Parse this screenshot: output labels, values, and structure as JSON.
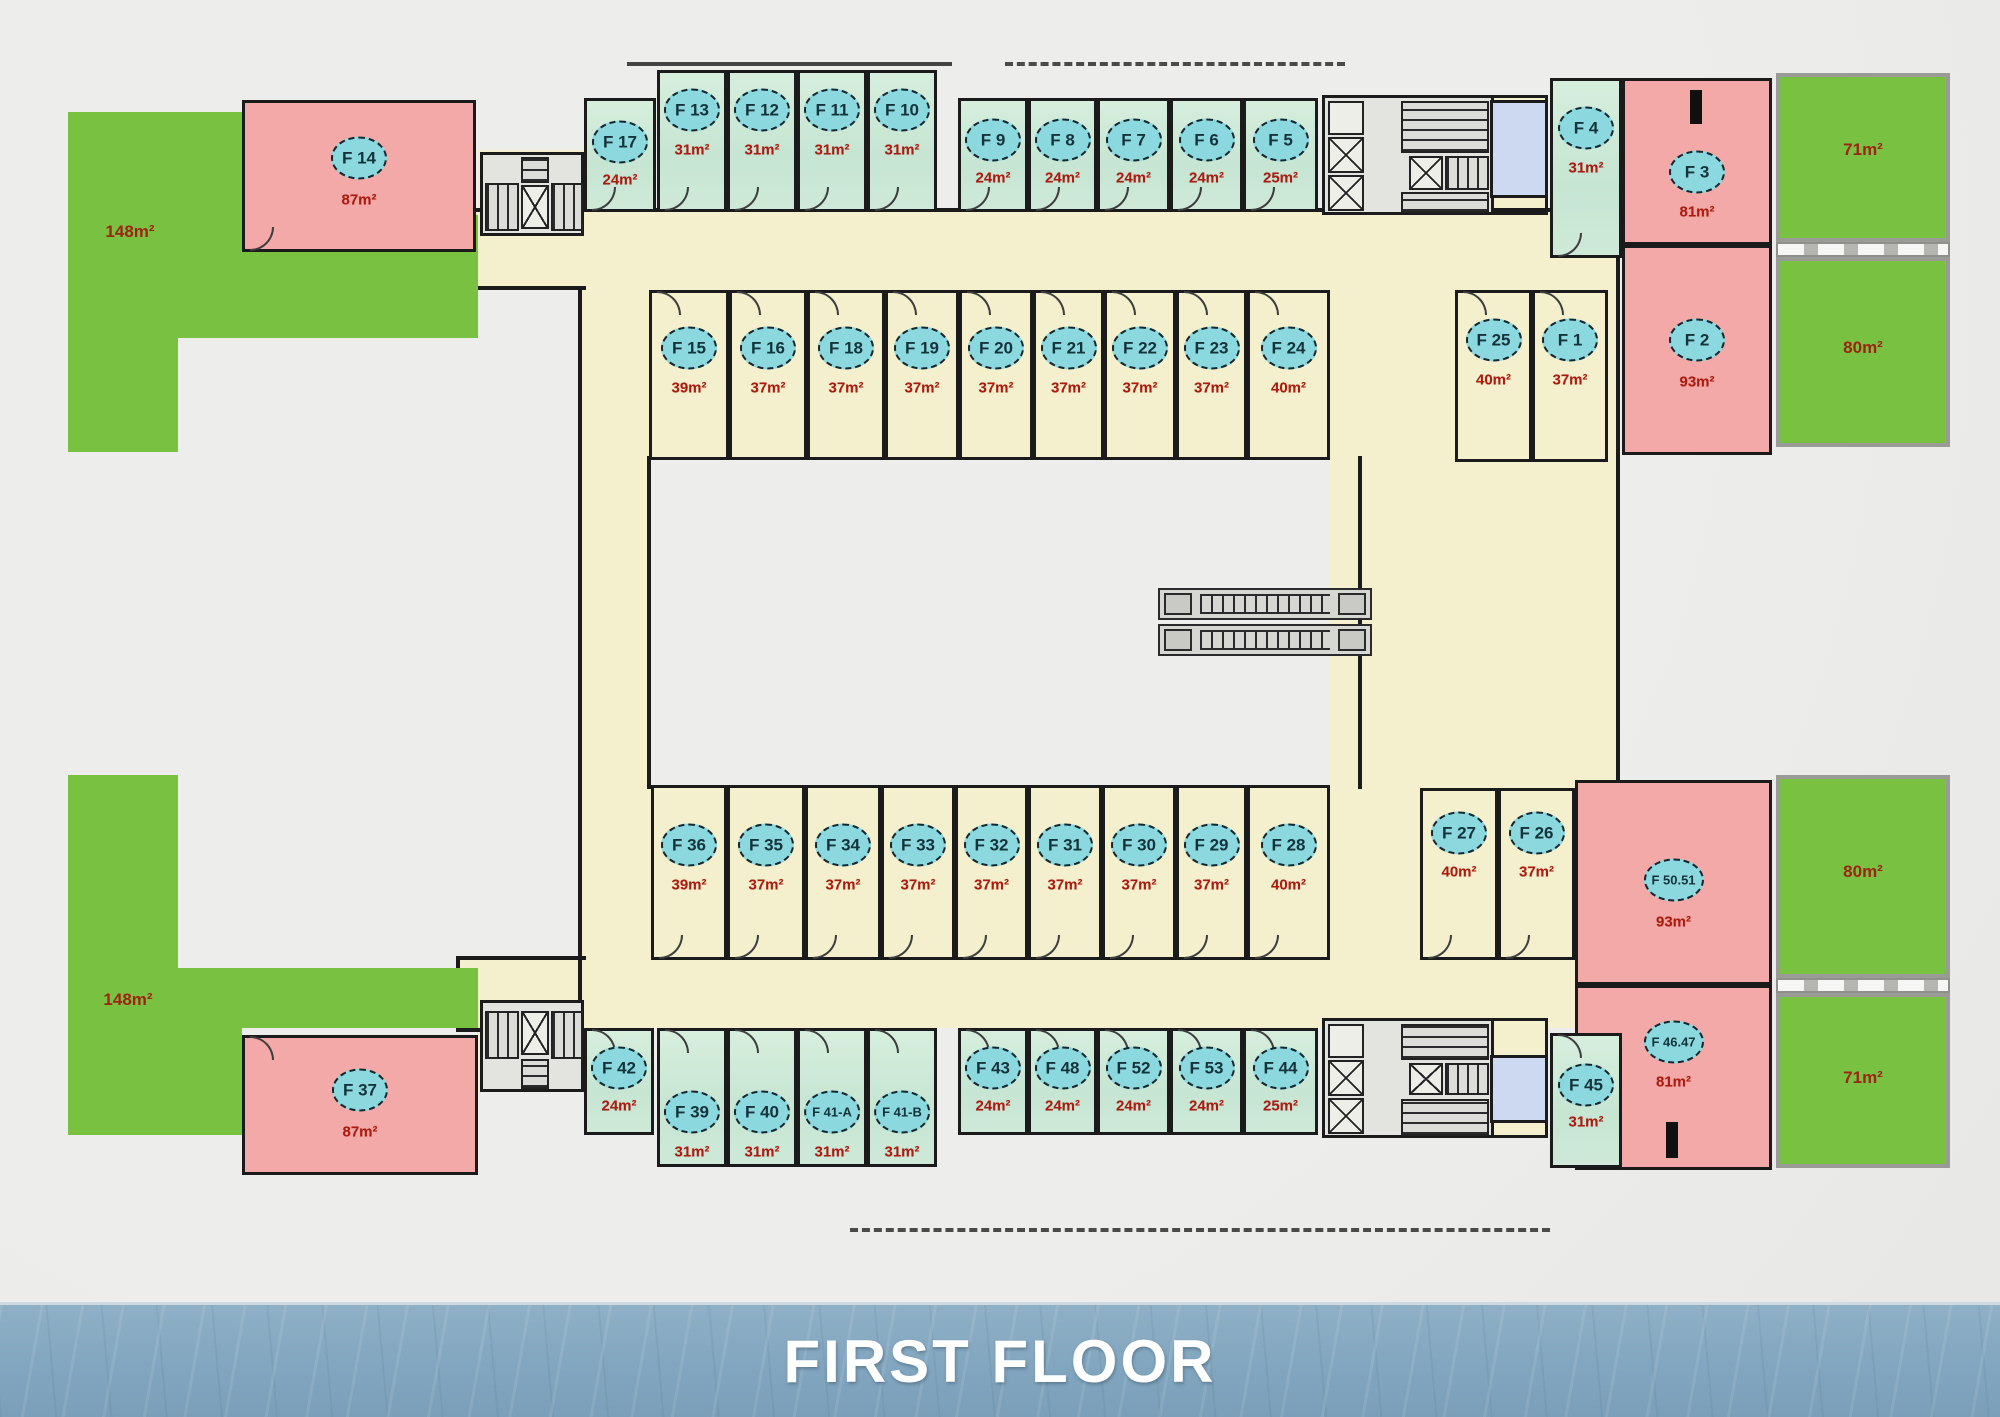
{
  "banner": {
    "title": "FIRST FLOOR"
  },
  "colors": {
    "terrace_green": "#79c141",
    "unit_pink": "#f3a9a7",
    "unit_teal": "#cde9d8",
    "unit_cream": "#f4f0cd",
    "wc_blue": "#cdd9f0",
    "badge_cyan": "#8bd8de",
    "area_red": "#ab1b10",
    "wall_black": "#1b1b1b",
    "banner_blue": "#82a6bf"
  },
  "rooms": [
    {
      "id": "F14",
      "label": "F 14",
      "area": "87m²",
      "fill": "pink",
      "x": 242,
      "y": 100,
      "w": 234,
      "h": 152,
      "by": 158,
      "ay": 200,
      "door": "bottom"
    },
    {
      "id": "F37",
      "label": "F 37",
      "area": "87m²",
      "fill": "pink",
      "x": 242,
      "y": 1035,
      "w": 236,
      "h": 140,
      "by": 1090,
      "ay": 1132,
      "door": "top"
    },
    {
      "id": "F17",
      "label": "F 17",
      "area": "24m²",
      "fill": "teal",
      "x": 584,
      "y": 98,
      "w": 72,
      "h": 114,
      "by": 142,
      "ay": 180,
      "door": "bottom"
    },
    {
      "id": "F13",
      "label": "F 13",
      "area": "31m²",
      "fill": "teal",
      "x": 657,
      "y": 70,
      "w": 70,
      "h": 142,
      "by": 110,
      "ay": 150,
      "door": "bottom"
    },
    {
      "id": "F12",
      "label": "F 12",
      "area": "31m²",
      "fill": "teal",
      "x": 727,
      "y": 70,
      "w": 70,
      "h": 142,
      "by": 110,
      "ay": 150,
      "door": "bottom"
    },
    {
      "id": "F11",
      "label": "F 11",
      "area": "31m²",
      "fill": "teal",
      "x": 797,
      "y": 70,
      "w": 70,
      "h": 142,
      "by": 110,
      "ay": 150,
      "door": "bottom"
    },
    {
      "id": "F10",
      "label": "F 10",
      "area": "31m²",
      "fill": "teal",
      "x": 867,
      "y": 70,
      "w": 70,
      "h": 142,
      "by": 110,
      "ay": 150,
      "door": "bottom"
    },
    {
      "id": "F9",
      "label": "F 9",
      "area": "24m²",
      "fill": "teal",
      "x": 958,
      "y": 98,
      "w": 70,
      "h": 114,
      "by": 140,
      "ay": 178,
      "door": "bottom"
    },
    {
      "id": "F8",
      "label": "F 8",
      "area": "24m²",
      "fill": "teal",
      "x": 1028,
      "y": 98,
      "w": 69,
      "h": 114,
      "by": 140,
      "ay": 178,
      "door": "bottom"
    },
    {
      "id": "F7",
      "label": "F 7",
      "area": "24m²",
      "fill": "teal",
      "x": 1097,
      "y": 98,
      "w": 73,
      "h": 114,
      "by": 140,
      "ay": 178,
      "door": "bottom"
    },
    {
      "id": "F6",
      "label": "F 6",
      "area": "24m²",
      "fill": "teal",
      "x": 1170,
      "y": 98,
      "w": 73,
      "h": 114,
      "by": 140,
      "ay": 178,
      "door": "bottom"
    },
    {
      "id": "F5",
      "label": "F 5",
      "area": "25m²",
      "fill": "teal",
      "x": 1243,
      "y": 98,
      "w": 75,
      "h": 114,
      "by": 140,
      "ay": 178,
      "door": "bottom"
    },
    {
      "id": "F4",
      "label": "F 4",
      "area": "31m²",
      "fill": "teal",
      "x": 1550,
      "y": 78,
      "w": 72,
      "h": 180,
      "by": 128,
      "ay": 168,
      "door": "bottom"
    },
    {
      "id": "F3",
      "label": "F 3",
      "area": "81m²",
      "fill": "pink",
      "x": 1622,
      "y": 78,
      "w": 150,
      "h": 167,
      "by": 172,
      "ay": 212,
      "door": "none"
    },
    {
      "id": "F2",
      "label": "F 2",
      "area": "93m²",
      "fill": "pink",
      "x": 1622,
      "y": 245,
      "w": 150,
      "h": 210,
      "by": 340,
      "ay": 382,
      "door": "none"
    },
    {
      "id": "F25",
      "label": "F 25",
      "area": "40m²",
      "fill": "cream",
      "x": 1455,
      "y": 290,
      "w": 77,
      "h": 172,
      "by": 340,
      "ay": 380,
      "door": "top"
    },
    {
      "id": "F1",
      "label": "F 1",
      "area": "37m²",
      "fill": "cream",
      "x": 1532,
      "y": 290,
      "w": 76,
      "h": 172,
      "by": 340,
      "ay": 380,
      "door": "top"
    },
    {
      "id": "F15",
      "label": "F 15",
      "area": "39m²",
      "fill": "cream",
      "x": 649,
      "y": 290,
      "w": 80,
      "h": 170,
      "by": 348,
      "ay": 388,
      "door": "top"
    },
    {
      "id": "F16",
      "label": "F 16",
      "area": "37m²",
      "fill": "cream",
      "x": 729,
      "y": 290,
      "w": 78,
      "h": 170,
      "by": 348,
      "ay": 388,
      "door": "top"
    },
    {
      "id": "F18",
      "label": "F 18",
      "area": "37m²",
      "fill": "cream",
      "x": 807,
      "y": 290,
      "w": 78,
      "h": 170,
      "by": 348,
      "ay": 388,
      "door": "top"
    },
    {
      "id": "F19",
      "label": "F 19",
      "area": "37m²",
      "fill": "cream",
      "x": 885,
      "y": 290,
      "w": 74,
      "h": 170,
      "by": 348,
      "ay": 388,
      "door": "top"
    },
    {
      "id": "F20",
      "label": "F 20",
      "area": "37m²",
      "fill": "cream",
      "x": 959,
      "y": 290,
      "w": 74,
      "h": 170,
      "by": 348,
      "ay": 388,
      "door": "top"
    },
    {
      "id": "F21",
      "label": "F 21",
      "area": "37m²",
      "fill": "cream",
      "x": 1033,
      "y": 290,
      "w": 71,
      "h": 170,
      "by": 348,
      "ay": 388,
      "door": "top"
    },
    {
      "id": "F22",
      "label": "F 22",
      "area": "37m²",
      "fill": "cream",
      "x": 1104,
      "y": 290,
      "w": 72,
      "h": 170,
      "by": 348,
      "ay": 388,
      "door": "top"
    },
    {
      "id": "F23",
      "label": "F 23",
      "area": "37m²",
      "fill": "cream",
      "x": 1176,
      "y": 290,
      "w": 71,
      "h": 170,
      "by": 348,
      "ay": 388,
      "door": "top"
    },
    {
      "id": "F24",
      "label": "F 24",
      "area": "40m²",
      "fill": "cream",
      "x": 1247,
      "y": 290,
      "w": 83,
      "h": 170,
      "by": 348,
      "ay": 388,
      "door": "top"
    },
    {
      "id": "F36",
      "label": "F 36",
      "area": "39m²",
      "fill": "cream",
      "x": 651,
      "y": 785,
      "w": 76,
      "h": 175,
      "by": 845,
      "ay": 885,
      "door": "bottom"
    },
    {
      "id": "F35",
      "label": "F 35",
      "area": "37m²",
      "fill": "cream",
      "x": 727,
      "y": 785,
      "w": 78,
      "h": 175,
      "by": 845,
      "ay": 885,
      "door": "bottom"
    },
    {
      "id": "F34",
      "label": "F 34",
      "area": "37m²",
      "fill": "cream",
      "x": 805,
      "y": 785,
      "w": 76,
      "h": 175,
      "by": 845,
      "ay": 885,
      "door": "bottom"
    },
    {
      "id": "F33",
      "label": "F 33",
      "area": "37m²",
      "fill": "cream",
      "x": 881,
      "y": 785,
      "w": 74,
      "h": 175,
      "by": 845,
      "ay": 885,
      "door": "bottom"
    },
    {
      "id": "F32",
      "label": "F 32",
      "area": "37m²",
      "fill": "cream",
      "x": 955,
      "y": 785,
      "w": 73,
      "h": 175,
      "by": 845,
      "ay": 885,
      "door": "bottom"
    },
    {
      "id": "F31",
      "label": "F 31",
      "area": "37m²",
      "fill": "cream",
      "x": 1028,
      "y": 785,
      "w": 74,
      "h": 175,
      "by": 845,
      "ay": 885,
      "door": "bottom"
    },
    {
      "id": "F30",
      "label": "F 30",
      "area": "37m²",
      "fill": "cream",
      "x": 1102,
      "y": 785,
      "w": 74,
      "h": 175,
      "by": 845,
      "ay": 885,
      "door": "bottom"
    },
    {
      "id": "F29",
      "label": "F 29",
      "area": "37m²",
      "fill": "cream",
      "x": 1176,
      "y": 785,
      "w": 71,
      "h": 175,
      "by": 845,
      "ay": 885,
      "door": "bottom"
    },
    {
      "id": "F28",
      "label": "F 28",
      "area": "40m²",
      "fill": "cream",
      "x": 1247,
      "y": 785,
      "w": 83,
      "h": 175,
      "by": 845,
      "ay": 885,
      "door": "bottom"
    },
    {
      "id": "F27",
      "label": "F 27",
      "area": "40m²",
      "fill": "cream",
      "x": 1420,
      "y": 788,
      "w": 78,
      "h": 172,
      "by": 833,
      "ay": 872,
      "door": "bottom"
    },
    {
      "id": "F26",
      "label": "F 26",
      "area": "37m²",
      "fill": "cream",
      "x": 1498,
      "y": 788,
      "w": 77,
      "h": 172,
      "by": 833,
      "ay": 872,
      "door": "bottom"
    },
    {
      "id": "F50.51",
      "label": "F 50.51",
      "area": "93m²",
      "fill": "pink",
      "x": 1575,
      "y": 780,
      "w": 197,
      "h": 205,
      "by": 880,
      "ay": 922,
      "door": "none"
    },
    {
      "id": "F46.47",
      "label": "F 46.47",
      "area": "81m²",
      "fill": "pink",
      "x": 1575,
      "y": 985,
      "w": 197,
      "h": 185,
      "by": 1042,
      "ay": 1082,
      "door": "none"
    },
    {
      "id": "F45",
      "label": "F 45",
      "area": "31m²",
      "fill": "teal",
      "x": 1550,
      "y": 1033,
      "w": 72,
      "h": 135,
      "by": 1085,
      "ay": 1122,
      "door": "top"
    },
    {
      "id": "F42",
      "label": "F 42",
      "area": "24m²",
      "fill": "teal",
      "x": 584,
      "y": 1028,
      "w": 70,
      "h": 107,
      "by": 1068,
      "ay": 1106,
      "door": "top"
    },
    {
      "id": "F39",
      "label": "F 39",
      "area": "31m²",
      "fill": "teal",
      "x": 657,
      "y": 1028,
      "w": 70,
      "h": 139,
      "by": 1112,
      "ay": 1152,
      "door": "top"
    },
    {
      "id": "F40",
      "label": "F 40",
      "area": "31m²",
      "fill": "teal",
      "x": 727,
      "y": 1028,
      "w": 70,
      "h": 139,
      "by": 1112,
      "ay": 1152,
      "door": "top"
    },
    {
      "id": "F41-A",
      "label": "F 41-A",
      "area": "31m²",
      "fill": "teal",
      "x": 797,
      "y": 1028,
      "w": 70,
      "h": 139,
      "by": 1112,
      "ay": 1152,
      "door": "top"
    },
    {
      "id": "F41-B",
      "label": "F 41-B",
      "area": "31m²",
      "fill": "teal",
      "x": 867,
      "y": 1028,
      "w": 70,
      "h": 139,
      "by": 1112,
      "ay": 1152,
      "door": "top"
    },
    {
      "id": "F43",
      "label": "F 43",
      "area": "24m²",
      "fill": "teal",
      "x": 958,
      "y": 1028,
      "w": 70,
      "h": 107,
      "by": 1068,
      "ay": 1106,
      "door": "top"
    },
    {
      "id": "F48",
      "label": "F 48",
      "area": "24m²",
      "fill": "teal",
      "x": 1028,
      "y": 1028,
      "w": 69,
      "h": 107,
      "by": 1068,
      "ay": 1106,
      "door": "top"
    },
    {
      "id": "F52",
      "label": "F 52",
      "area": "24m²",
      "fill": "teal",
      "x": 1097,
      "y": 1028,
      "w": 73,
      "h": 107,
      "by": 1068,
      "ay": 1106,
      "door": "top"
    },
    {
      "id": "F53",
      "label": "F 53",
      "area": "24m²",
      "fill": "teal",
      "x": 1170,
      "y": 1028,
      "w": 73,
      "h": 107,
      "by": 1068,
      "ay": 1106,
      "door": "top"
    },
    {
      "id": "F44",
      "label": "F 44",
      "area": "25m²",
      "fill": "teal",
      "x": 1243,
      "y": 1028,
      "w": 75,
      "h": 107,
      "by": 1068,
      "ay": 1106,
      "door": "top"
    }
  ],
  "terraces": [
    {
      "id": "terrace-top-left",
      "area": "148m²",
      "x": 68,
      "y": 112,
      "w": 410,
      "h": 340,
      "lx": 130,
      "ly": 232,
      "clip": "polygon(0px 0px,174px 0px,174px 103px,410px 103px,410px 226px,110px 226px,110px 340px,0px 340px)"
    },
    {
      "id": "terrace-bottom-left",
      "area": "148m²",
      "x": 68,
      "y": 775,
      "w": 410,
      "h": 360,
      "lx": 128,
      "ly": 1000,
      "clip": "polygon(0px 0px,110px 0px,110px 193px,410px 193px,410px 253px,174px 253px,174px 360px,0px 360px)"
    },
    {
      "id": "terrace-top-right-71",
      "area": "71m²",
      "x": 1776,
      "y": 73,
      "w": 174,
      "h": 169,
      "lx": 1863,
      "ly": 150,
      "clip": null
    },
    {
      "id": "terrace-top-right-80",
      "area": "80m²",
      "x": 1776,
      "y": 257,
      "w": 174,
      "h": 190,
      "lx": 1863,
      "ly": 348,
      "clip": null
    },
    {
      "id": "terrace-bottom-right-80",
      "area": "80m²",
      "x": 1776,
      "y": 775,
      "w": 174,
      "h": 203,
      "lx": 1863,
      "ly": 872,
      "clip": null
    },
    {
      "id": "terrace-bottom-right-71",
      "area": "71m²",
      "x": 1776,
      "y": 993,
      "w": 174,
      "h": 175,
      "lx": 1863,
      "ly": 1078,
      "clip": null
    }
  ]
}
